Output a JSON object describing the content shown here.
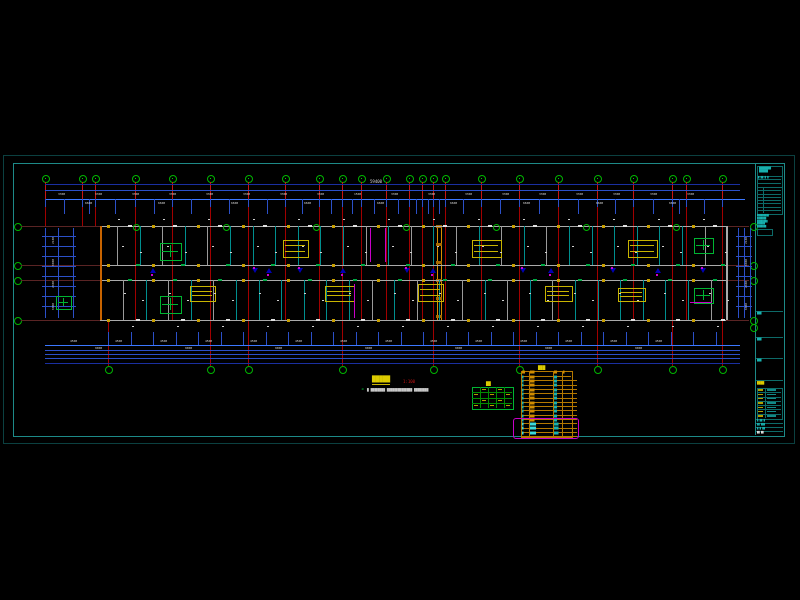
{
  "colors": {
    "frame_outer": "#0b4040",
    "frame_inner": "#1d8a88",
    "cyan": "#18b0ae",
    "cyan_dim": "#0d6a68",
    "red": "#a00000",
    "red_bright": "#c81414",
    "orange": "#c86400",
    "joint": "#d98e00",
    "blue": "#2b50c8",
    "blue_bright": "#3c78ff",
    "blue_dark": "#1a2fa0",
    "arrow": "#0000b4",
    "white": "#d8d8d8",
    "wall_grey": "#aaaaaa",
    "teal_wall": "#008f8f",
    "green": "#00b432",
    "yellow": "#c8b400",
    "yellow_text": "#ddcc00",
    "magenta": "#c800c8",
    "dim_red": "#5a2424"
  },
  "sheet": {
    "outer": {
      "x": 3,
      "y": 155,
      "w": 790,
      "h": 287
    },
    "inner": {
      "x": 13,
      "y": 163,
      "w": 770,
      "h": 272
    },
    "title_block_x": 755
  },
  "grids": {
    "top_bubbles_x": [
      45,
      82,
      95,
      135,
      172,
      210,
      248,
      285,
      319,
      342,
      361,
      386,
      409,
      422,
      433,
      445,
      481,
      519,
      558,
      597,
      633,
      672,
      686,
      722
    ],
    "bubble_labels": [
      "1",
      "2",
      "3",
      "4",
      "5",
      "6",
      "7",
      "8",
      "9",
      "10",
      "11",
      "12",
      "13",
      "14",
      "15",
      "16",
      "17",
      "18",
      "19",
      "20",
      "21",
      "22",
      "23",
      "24"
    ],
    "bottom_bubbles_x": [
      108,
      210,
      248,
      342,
      433,
      519,
      597,
      672,
      722
    ],
    "h_grid_y": [
      226,
      265,
      280,
      320
    ],
    "h_grid_labels": [
      "D",
      "C",
      "B",
      "A"
    ],
    "building": {
      "left": 100,
      "right": 726,
      "top": 226,
      "bottom": 320
    },
    "joint_x": [
      437,
      441
    ]
  },
  "dims": {
    "overall_top": "59400",
    "top_row1": [
      "3300",
      "3300",
      "3300",
      "3300",
      "3300",
      "3300",
      "3300",
      "3300",
      "1500",
      "3300",
      "3300",
      "3300",
      "3300",
      "3300",
      "3300",
      "3300",
      "3300",
      "3300"
    ],
    "top_row2": [
      "6600",
      "6600",
      "6600",
      "6600",
      "6600",
      "6600",
      "6600",
      "6600",
      "6600"
    ],
    "bottom_row1": [
      "4500",
      "4500",
      "4500",
      "4500",
      "4500",
      "4500",
      "4500",
      "4500",
      "4500",
      "4500",
      "4500",
      "4500",
      "4500",
      "4500"
    ],
    "bottom_row2": [
      "9000",
      "9000",
      "9000",
      "9000",
      "9000",
      "9000",
      "9000"
    ],
    "left_chain": [
      "2100",
      "6000",
      "2400",
      "6000"
    ],
    "right_chain": [
      "2100",
      "6000",
      "2400",
      "6000"
    ]
  },
  "furniture_yellow": [
    {
      "x": 283,
      "y": 240,
      "w": 24,
      "h": 16
    },
    {
      "x": 472,
      "y": 240,
      "w": 28,
      "h": 16
    },
    {
      "x": 628,
      "y": 240,
      "w": 28,
      "h": 16
    },
    {
      "x": 190,
      "y": 286,
      "w": 24,
      "h": 14
    },
    {
      "x": 325,
      "y": 286,
      "w": 28,
      "h": 14
    },
    {
      "x": 418,
      "y": 284,
      "w": 24,
      "h": 16
    },
    {
      "x": 545,
      "y": 286,
      "w": 26,
      "h": 14
    },
    {
      "x": 618,
      "y": 288,
      "w": 26,
      "h": 12
    }
  ],
  "fixtures_green": [
    {
      "x": 160,
      "y": 243,
      "w": 20,
      "h": 16
    },
    {
      "x": 694,
      "y": 238,
      "w": 18,
      "h": 14
    },
    {
      "x": 160,
      "y": 296,
      "w": 20,
      "h": 16
    },
    {
      "x": 694,
      "y": 288,
      "w": 18,
      "h": 14
    },
    {
      "x": 56,
      "y": 296,
      "w": 14,
      "h": 12
    }
  ],
  "magenta_vlines": [
    {
      "x": 370,
      "y1": 228,
      "y2": 262
    },
    {
      "x": 385,
      "y1": 228,
      "y2": 262
    },
    {
      "x": 354,
      "y1": 284,
      "y2": 318
    }
  ],
  "magenta_hline": {
    "x1": 690,
    "x2": 712,
    "y": 302
  },
  "corridor_arrows_x": [
    150,
    252,
    266,
    297,
    340,
    404,
    430,
    520,
    548,
    610,
    655,
    700
  ],
  "annotations": {
    "title": "█████",
    "scale": "1:100",
    "note_bullet": "◄",
    "note": "█ ████████ ██████████████ ████████"
  },
  "legend_table": {
    "title": "██",
    "x": 472,
    "y": 387,
    "w": 40,
    "h": 21,
    "rows": 4,
    "cols": 5
  },
  "schedule_table": {
    "title": "███",
    "x": 521,
    "y": 371,
    "w": 50,
    "row_h": 4.3,
    "header": [
      "██",
      "███",
      "██",
      "█"
    ],
    "rows": [
      {
        "a": "█",
        "b": "███",
        "c": "██"
      },
      {
        "a": "█",
        "b": "███",
        "c": "██"
      },
      {
        "a": "█",
        "b": "███",
        "c": "██"
      },
      {
        "a": "█",
        "b": "███",
        "c": "██"
      },
      {
        "a": "█",
        "b": "███",
        "c": "██"
      },
      {
        "a": "█",
        "b": "███",
        "c": "██"
      },
      {
        "a": "█",
        "b": "███",
        "c": "██"
      },
      {
        "a": "█",
        "b": "███",
        "c": "██"
      },
      {
        "a": "█",
        "b": "███",
        "c": "██"
      },
      {
        "a": "█",
        "b": "███",
        "c": "██"
      },
      {
        "a": "█",
        "b": "███",
        "c": "██"
      },
      {
        "a": "█",
        "b": "████",
        "c": "███"
      },
      {
        "a": "█",
        "b": "████",
        "c": "███"
      },
      {
        "a": "█",
        "b": "████",
        "c": "███"
      }
    ],
    "highlight_last": 3
  },
  "selection_rect": {
    "x": 513,
    "y": 418,
    "w": 64,
    "h": 19
  },
  "title_block": {
    "logo_lines": [
      "████████",
      "██████"
    ],
    "note_lines": [
      "█████████",
      "███████",
      "████████",
      "██████",
      "███████"
    ],
    "section_labels": [
      "███",
      "███",
      "███"
    ],
    "project_label": "████",
    "lower_rows": 7,
    "bottom_rows": [
      "█ ██ █",
      "██ ███",
      "█ █ ██",
      "██ ██"
    ]
  }
}
